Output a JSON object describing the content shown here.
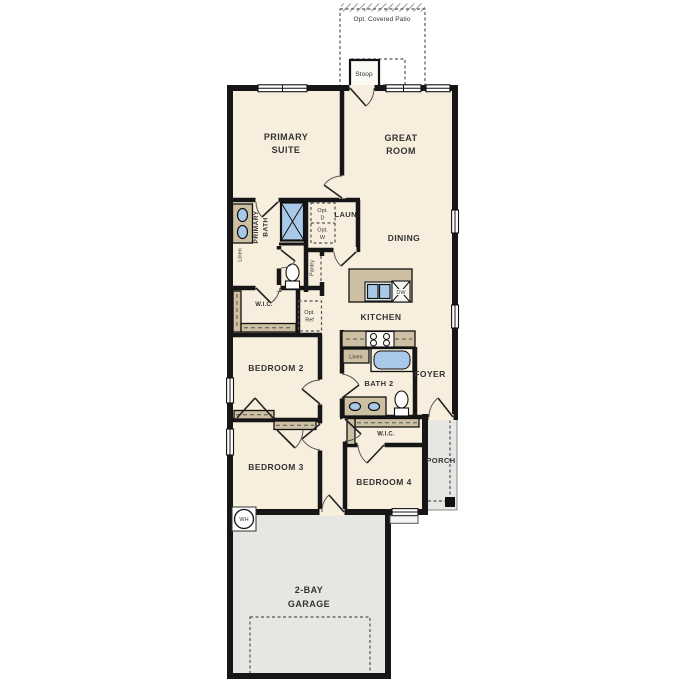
{
  "plan_title": "single-story-floor-plan",
  "colors": {
    "wall": "#161616",
    "floor": "#f7eedd",
    "cabinet": "#cdbfa2",
    "fixture": "#a9c9e8",
    "concrete": "#e6e6e3",
    "text": "#333333",
    "background": "#ffffff"
  },
  "rooms": {
    "patio": "Opt. Covered Patio",
    "stoop": "Stoop",
    "primary_suite_line1": "PRIMARY",
    "primary_suite_line2": "SUITE",
    "great_room_line1": "GREAT",
    "great_room_line2": "ROOM",
    "primary_bath_line1": "PRIMARY",
    "primary_bath_line2": "BATH",
    "laundry": "LAUN.",
    "opt_dryer_line1": "Opt.",
    "opt_dryer_line2": "D",
    "opt_washer_line1": "Opt.",
    "opt_washer_line2": "W",
    "linen_primary": "Linen",
    "pantry": "Pantry",
    "dining": "DINING",
    "wic_primary": "W.I.C.",
    "opt_ref_line1": "Opt.",
    "opt_ref_line2": "Ref",
    "kitchen": "KITCHEN",
    "dishwasher": "DW",
    "bedroom2": "BEDROOM 2",
    "linen_bath2": "Linen",
    "bath2": "BATH 2",
    "foyer": "FOYER",
    "bedroom3": "BEDROOM 3",
    "wic_bedroom4": "W.I.C.",
    "bedroom4": "BEDROOM 4",
    "porch": "PORCH",
    "water_heater": "WH",
    "garage_line1": "2-BAY",
    "garage_line2": "GARAGE"
  }
}
